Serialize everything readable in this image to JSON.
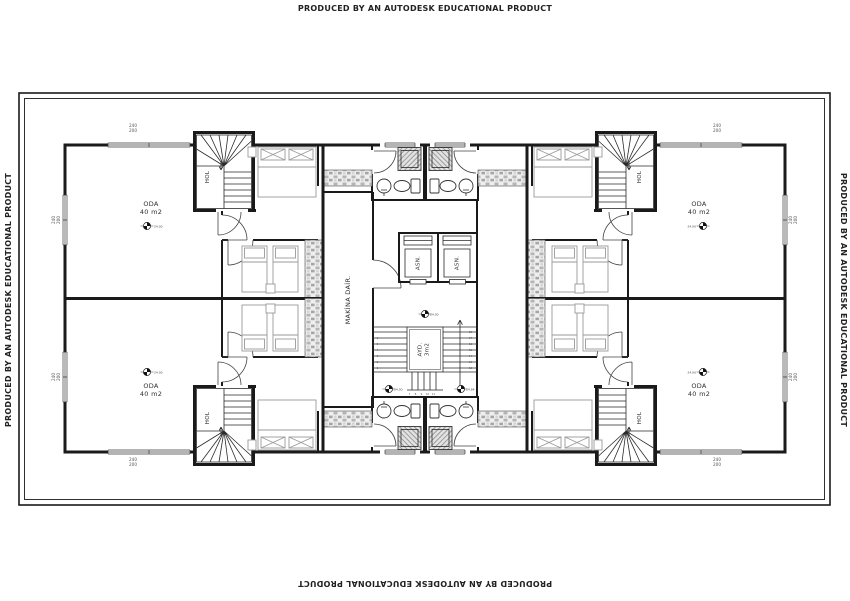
{
  "watermark": "PRODUCED BY AN AUTODESK EDUCATIONAL PRODUCT",
  "room": {
    "name": "ODA",
    "area": "40 m2",
    "level": "24.00"
  },
  "hall_label": "HOL",
  "elevator_label": "ASN.",
  "machine_room_label": "MAKİNA DAİR.",
  "lightwell": {
    "name": "AYD.",
    "area": "3m2"
  },
  "stair": {
    "level_top": "24.00",
    "level_bottom_left": "24.00",
    "level_bottom_right": "24.84",
    "treads_left": [
      "1",
      "2",
      "3",
      "4",
      "5",
      "6"
    ],
    "treads_bottom": [
      "7",
      "8",
      "9",
      "10",
      "11"
    ],
    "treads_right": [
      "12",
      "13",
      "14",
      "15",
      "16",
      "17",
      "18"
    ]
  },
  "window_dim": {
    "width": "240",
    "height": "200"
  },
  "colors": {
    "wall": "#1a1a1a",
    "furniture": "#9a9a9a",
    "hatch": "#8f8f8f",
    "watermark": "#222222"
  }
}
